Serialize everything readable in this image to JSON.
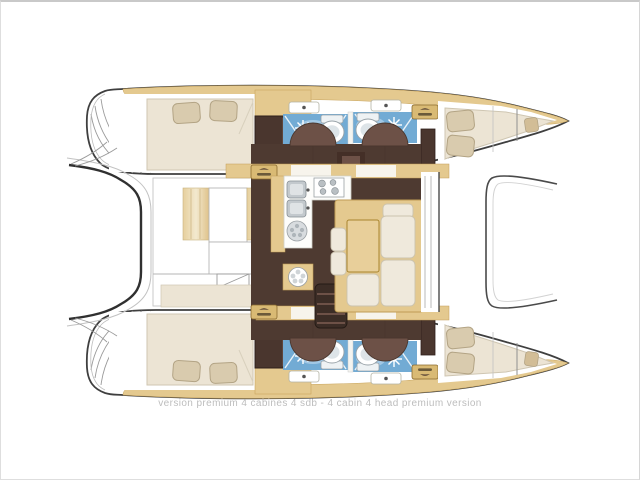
{
  "page": {
    "background": "#ffffff",
    "frame_border": "#c9c9c9"
  },
  "caption": {
    "text": "version premium 4 cabines 4 sdb - 4 cabin 4 head premium version",
    "color": "#bdbdbd"
  },
  "diagram": {
    "type": "catamaran-floor-plan",
    "orientation": "bow-right-stern-left",
    "version_label": "premium",
    "cabins_count": 4,
    "heads_count": 4,
    "colors": {
      "hull_outline": "#3f3f3f",
      "deck_wood": "#e4c98f",
      "floor_dark_brown": "#4e3a31",
      "door_swing_brown": "#6d5147",
      "bed_cream": "#ece4d4",
      "pillow_tan": "#d9cbae",
      "shower_blue": "#72abd4",
      "shower_blue_light": "#aecfe8",
      "fixture_gray": "#c3c9cd",
      "badge_gold": "#d9ba74"
    },
    "features": {
      "hulls": [
        "port-hull",
        "starboard-hull"
      ],
      "per_hull_rooms": [
        "aft-double-cabin",
        "head-with-shower",
        "head-with-shower",
        "forward-double-cabin",
        "bow-berth"
      ],
      "saloon": [
        "galley-sinks",
        "galley-stove",
        "dinette-table",
        "l-shaped-sofa",
        "companionway-steps"
      ],
      "exterior": [
        "stern-platform",
        "foredeck-trampoline"
      ],
      "icons": [
        "shower-sparkle-icon",
        "toilet-icon",
        "sink-icon",
        "stove-burner-icon",
        "brand-badge-icon"
      ]
    }
  }
}
